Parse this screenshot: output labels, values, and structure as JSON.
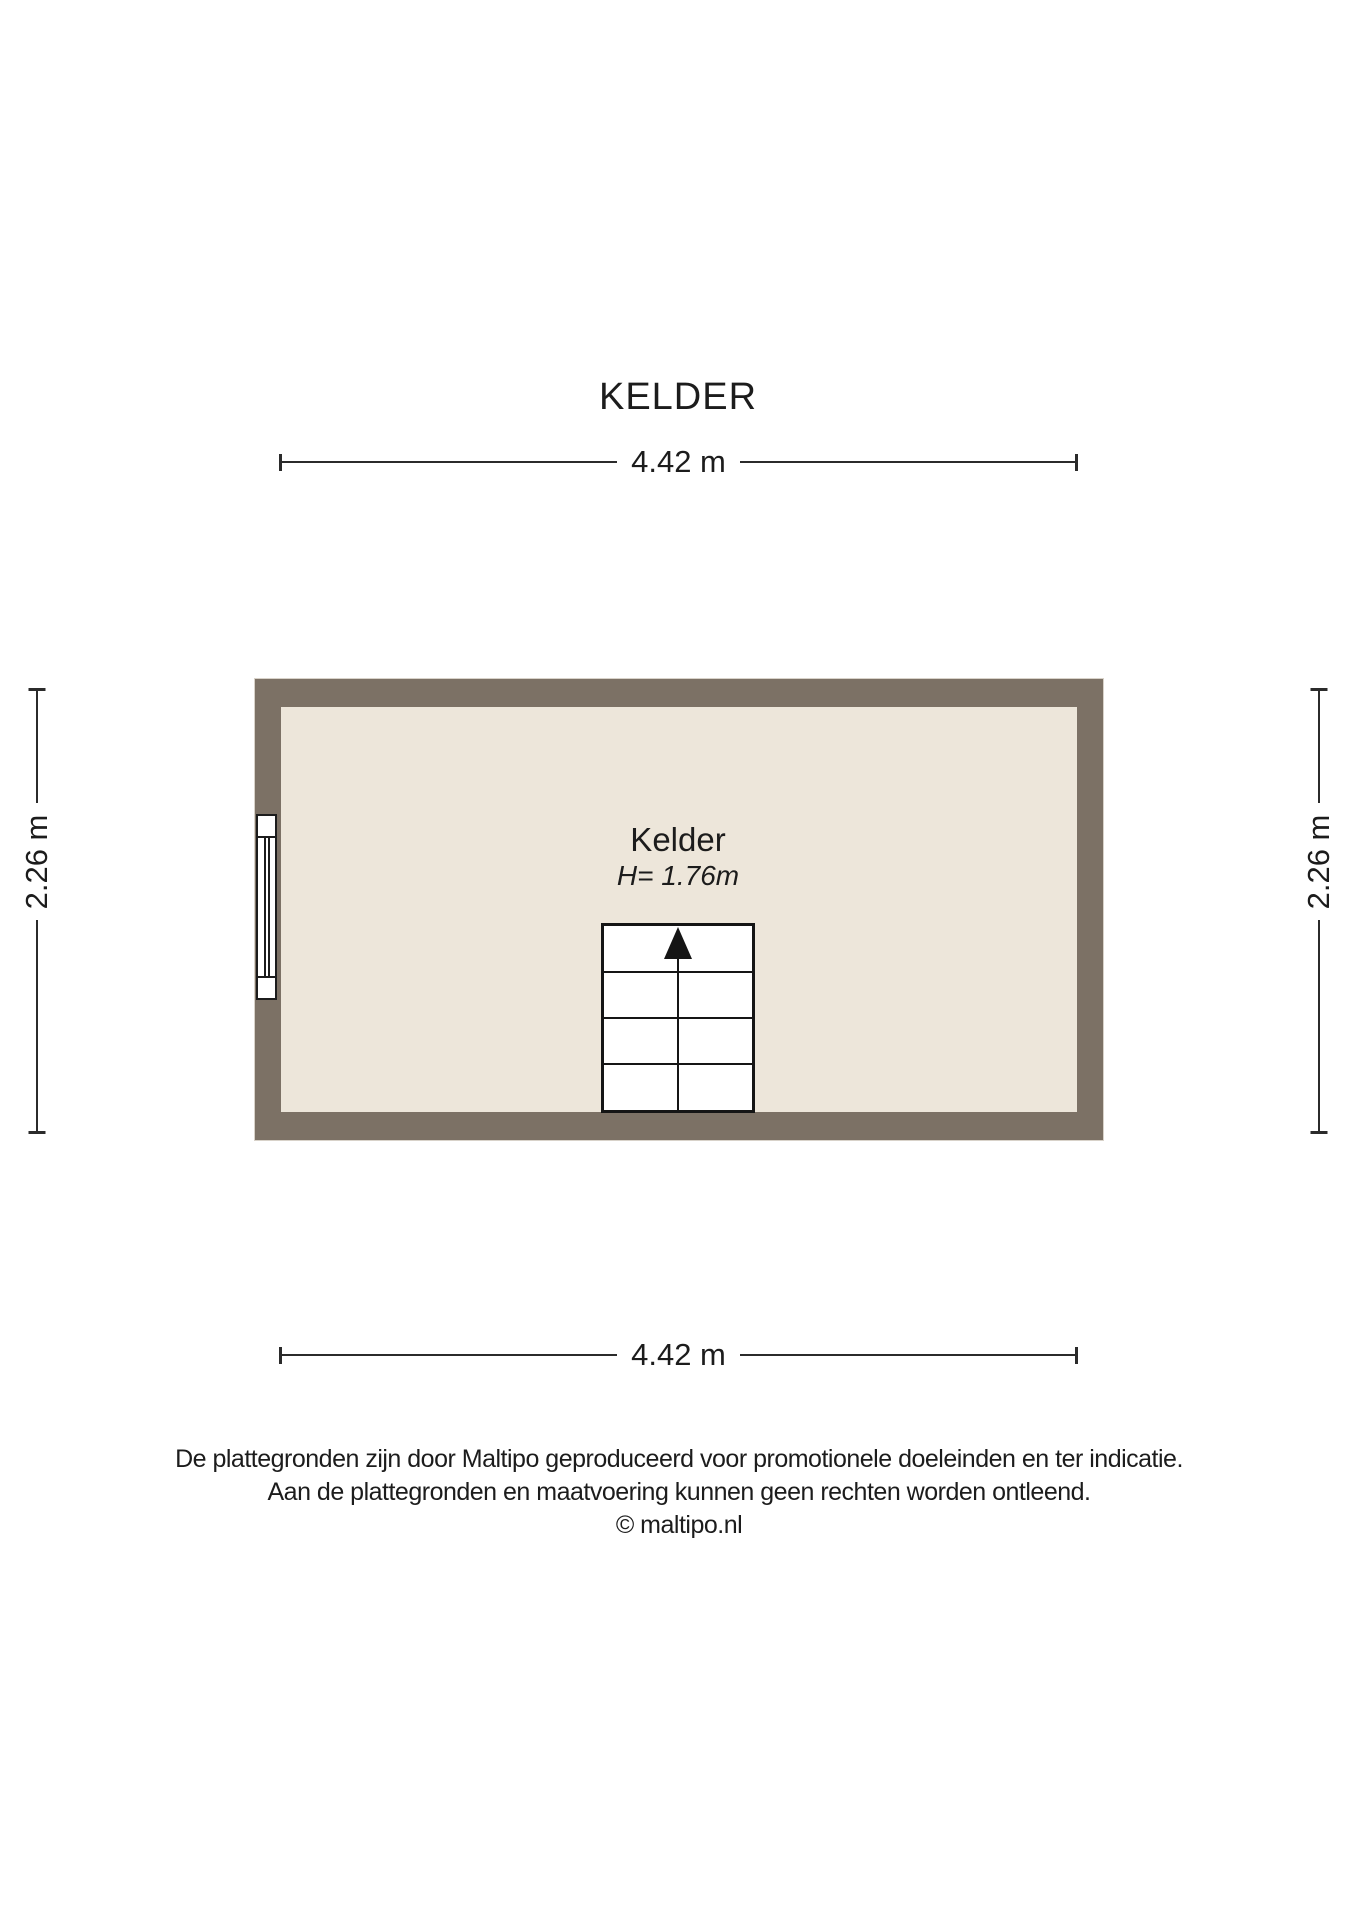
{
  "title": "KELDER",
  "room": {
    "label": "Kelder",
    "height_label": "H= 1.76m"
  },
  "dimensions": {
    "top": "4.42 m",
    "bottom": "4.42 m",
    "left": "2.26 m",
    "right": "2.26 m"
  },
  "icons": {
    "stairs_arrow": "up-arrow"
  },
  "colors": {
    "wall": "#7c7165",
    "floor": "#ede6da",
    "line": "#1c1c1c",
    "background": "#ffffff"
  },
  "footer": {
    "line1": "De plattegronden zijn door Maltipo geproduceerd voor promotionele doeleinden en ter indicatie.",
    "line2": "Aan de plattegronden en maatvoering kunnen geen rechten worden ontleend.",
    "line3": "© maltipo.nl"
  }
}
